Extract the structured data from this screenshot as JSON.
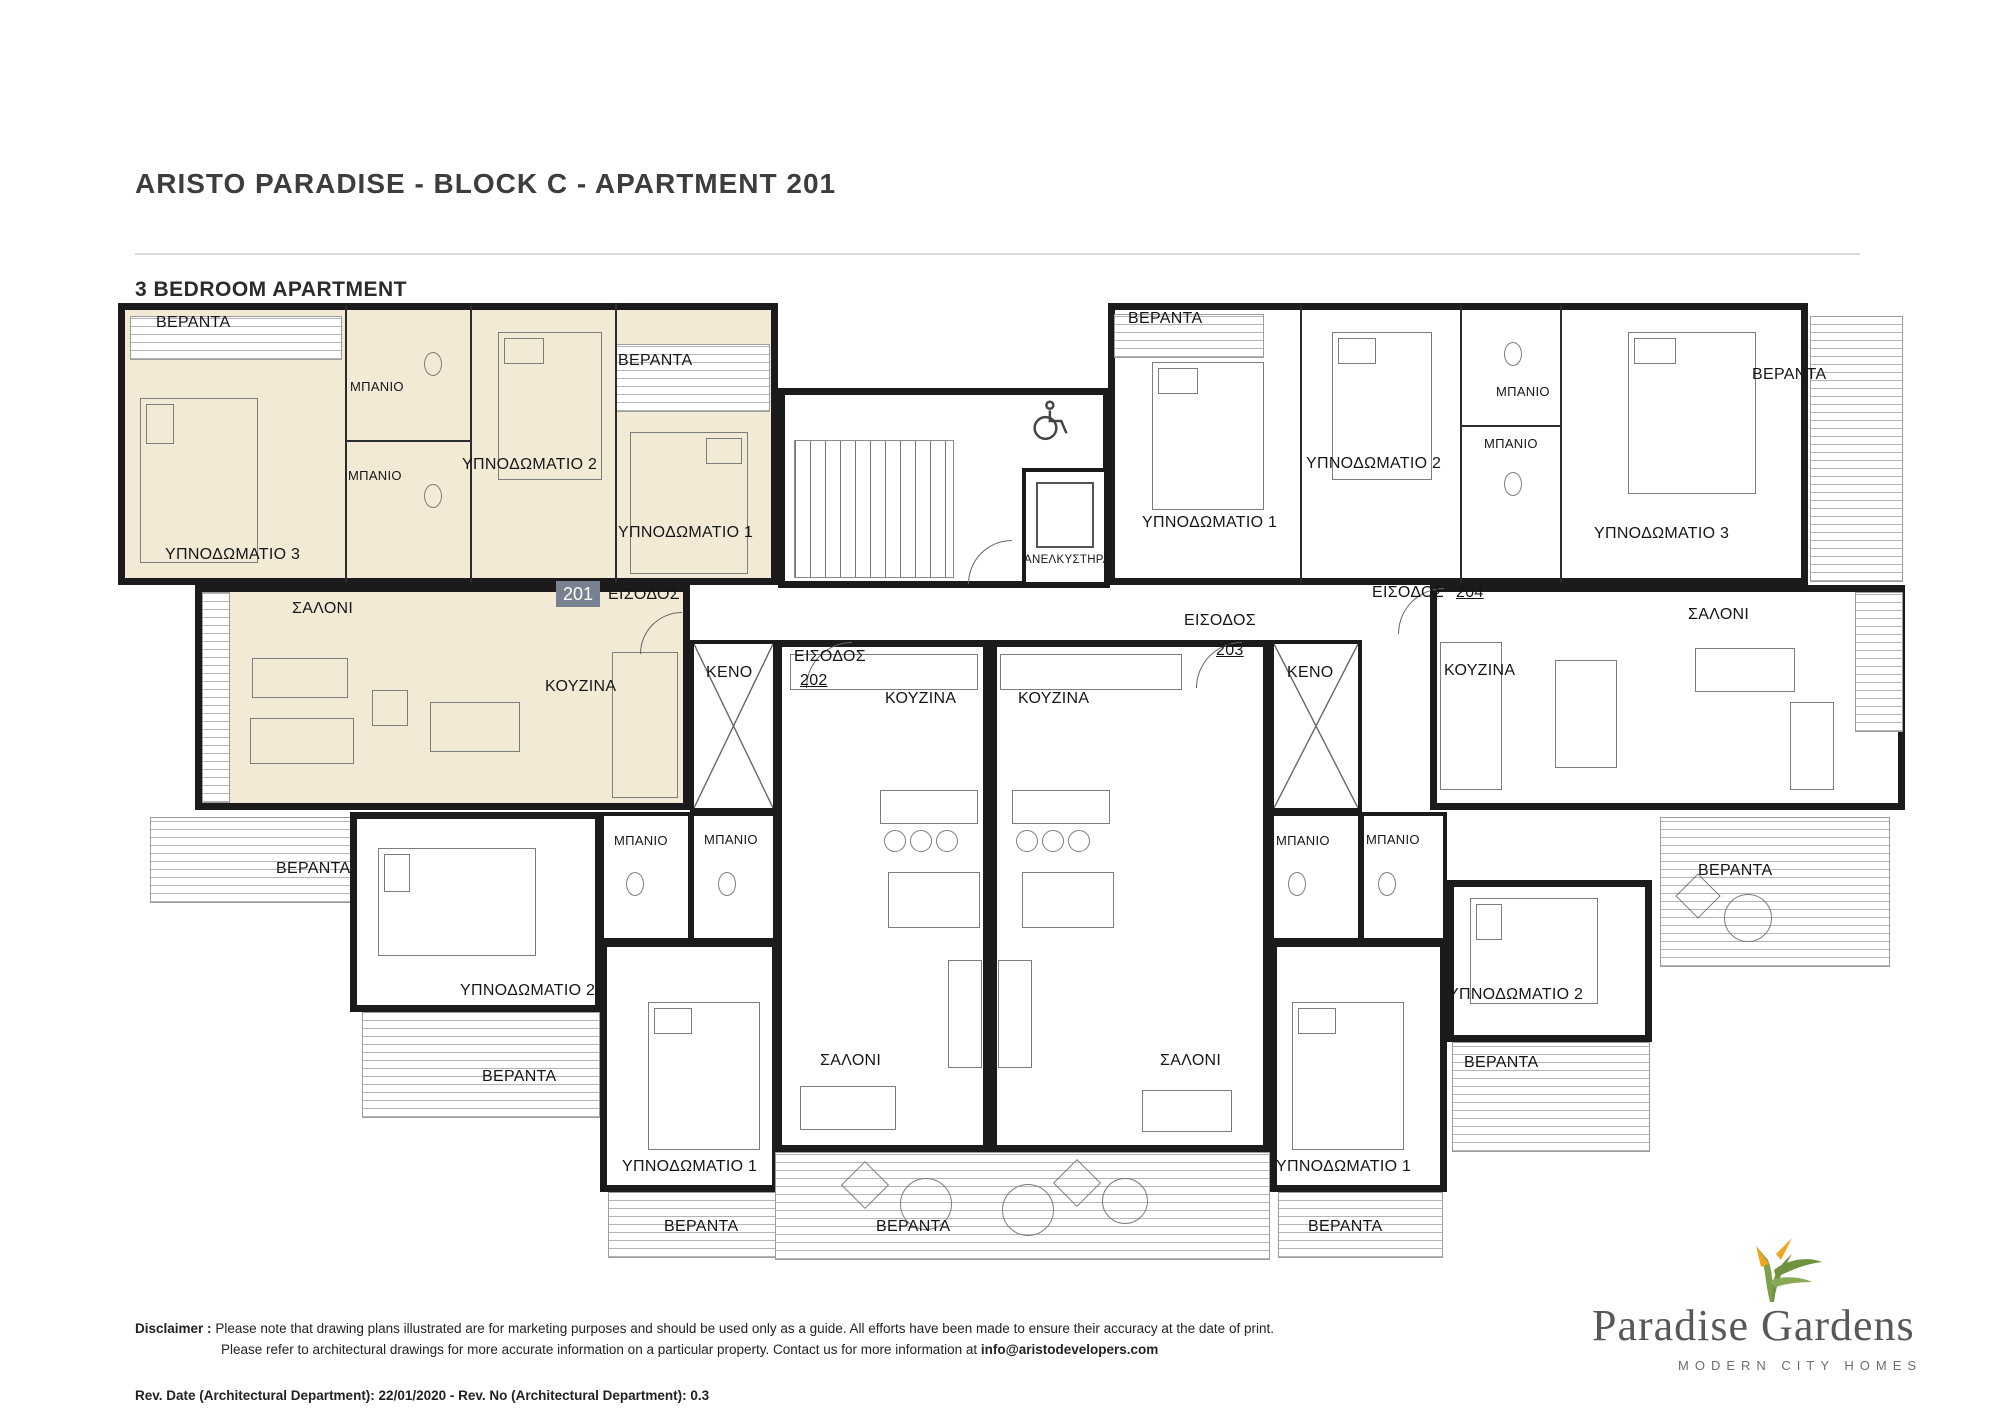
{
  "header": {
    "title": "ARISTO PARADISE  - BLOCK C - APARTMENT 201",
    "subtitle": "3 BEDROOM APARTMENT"
  },
  "rooms": {
    "veranda": "ΒΕΡΑΝΤΑ",
    "bathroom": "ΜΠΑΝΙΟ",
    "bedroom1": "ΥΠΝΟΔΩΜΑΤΙΟ 1",
    "bedroom2": "ΥΠΝΟΔΩΜΑΤΙΟ 2",
    "bedroom3": "ΥΠΝΟΔΩΜΑΤΙΟ 3",
    "salon": "ΣΑΛΟΝΙ",
    "kitchen": "ΚΟΥΖΙΝΑ",
    "void": "KENO",
    "entrance": "ΕΙΣΟΔΟΣ",
    "elevator": "ΑΝΕΛΚΥΣΤΗΡΑΣ"
  },
  "apartments": {
    "highlighted": "201",
    "a202": "202",
    "a203": "203",
    "a204": "204"
  },
  "colors": {
    "highlight_fill": "#f3ead6",
    "wall": "#1b1b1b",
    "badge": "#78818f",
    "hatch_line": "#b5b5b5"
  },
  "footer": {
    "disclaimer_label": "Disclaimer :",
    "line1": "Please note that drawing plans illustrated are for marketing purposes and should be used only as a guide. All efforts have been made to ensure their accuracy at the date of print.",
    "line2_prefix": "Please refer to architectural drawings for more accurate information on a particular property. Contact us for more information at ",
    "email": "info@aristodevelopers.com",
    "revision": "Rev. Date (Architectural Department): 22/01/2020 - Rev. No (Architectural Department): 0.3"
  },
  "logo": {
    "name": "Paradise Gardens",
    "tagline": "MODERN CITY HOMES"
  }
}
